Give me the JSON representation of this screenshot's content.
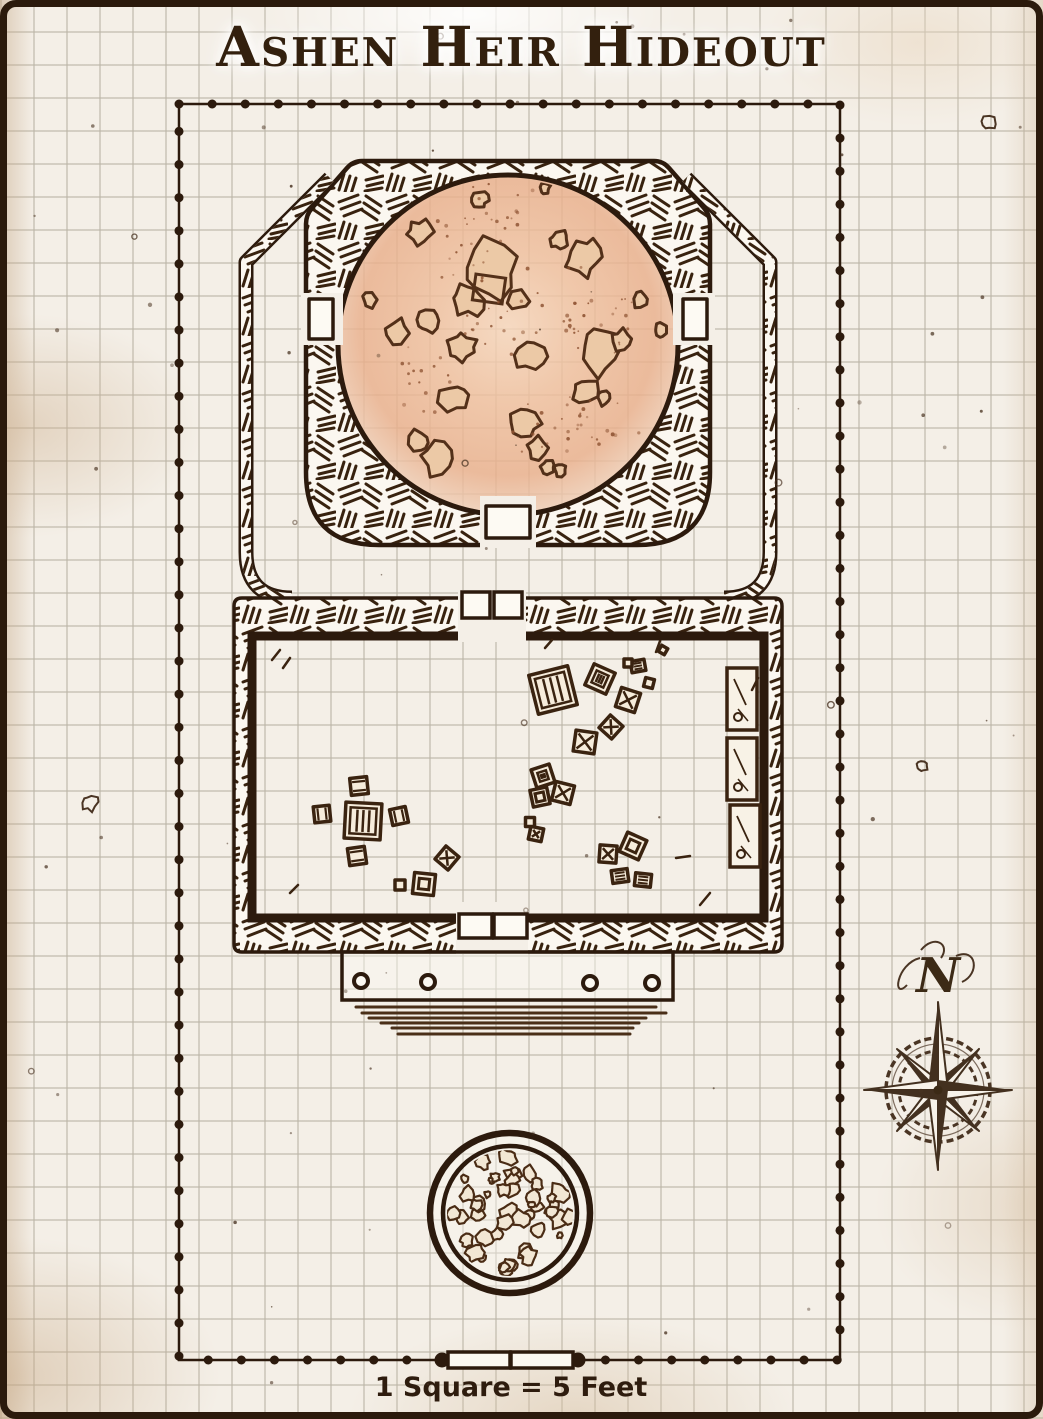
{
  "page": {
    "title": "Ashen Heir Hideout"
  },
  "compass": {
    "label": "N",
    "direction": "north"
  },
  "scale_bar": {
    "label": "1 Square = 5 Feet"
  },
  "map": {
    "rooms": [
      {
        "name": "ritual-cavern",
        "floor": "large circular rocky floor strewn with rubble"
      },
      {
        "name": "storage-room",
        "floor": "rectangular room with crates, a table with stools, and wall shelves"
      }
    ],
    "features": [
      "dotted-survey-boundary",
      "hatched-stone-walls",
      "double-doors",
      "entry-porch-with-steps",
      "debris-filled-well"
    ]
  },
  "colors": {
    "ink": "#2c1a0d",
    "parchment": "#f4efe7",
    "floor_tint": "#edbd9c",
    "compass": "#4a3524"
  }
}
